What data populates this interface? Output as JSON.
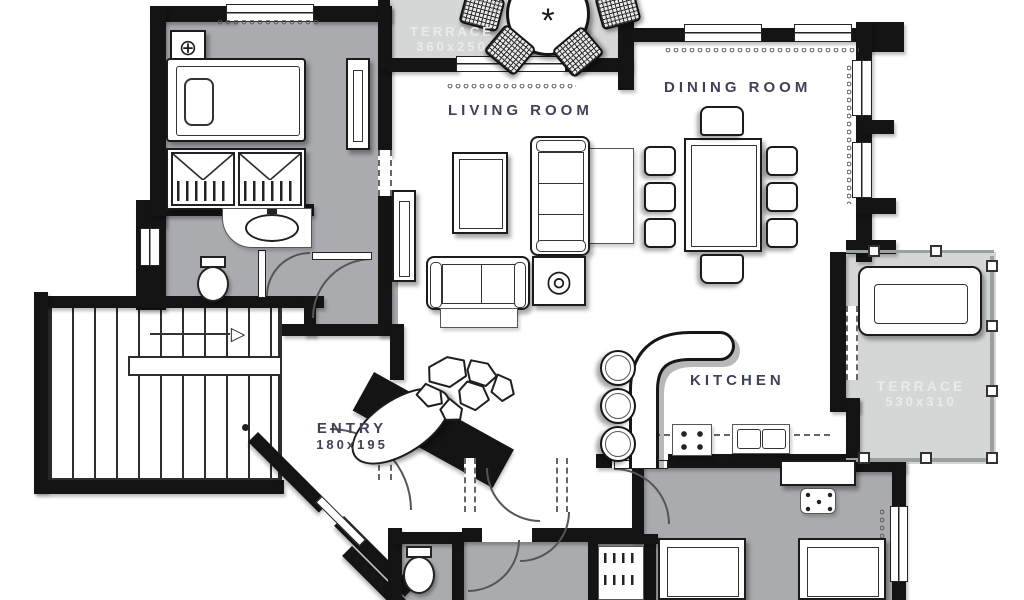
{
  "colors": {
    "background": "#ffffff",
    "wall": "#141414",
    "room_floor": "#a9abae",
    "terrace_floor": "#d4d7d6",
    "label_dark": "#3e4157",
    "label_light": "#e9ebea"
  },
  "rooms": {
    "terrace_top": {
      "name": "TERRACE",
      "size": "360x250"
    },
    "living_room": {
      "name": "LIVING ROOM"
    },
    "dining_room": {
      "name": "DINING ROOM"
    },
    "kitchen": {
      "name": "KITCHEN"
    },
    "entry": {
      "name": "ENTRY",
      "size": "180x195"
    },
    "terrace_right": {
      "name": "TERRACE",
      "size": "530x310"
    }
  },
  "icons": {
    "nightstand_decor": "⊕",
    "side_table_decor": "◎",
    "table_center_decor": "*",
    "stairs_arrow": "▷"
  }
}
